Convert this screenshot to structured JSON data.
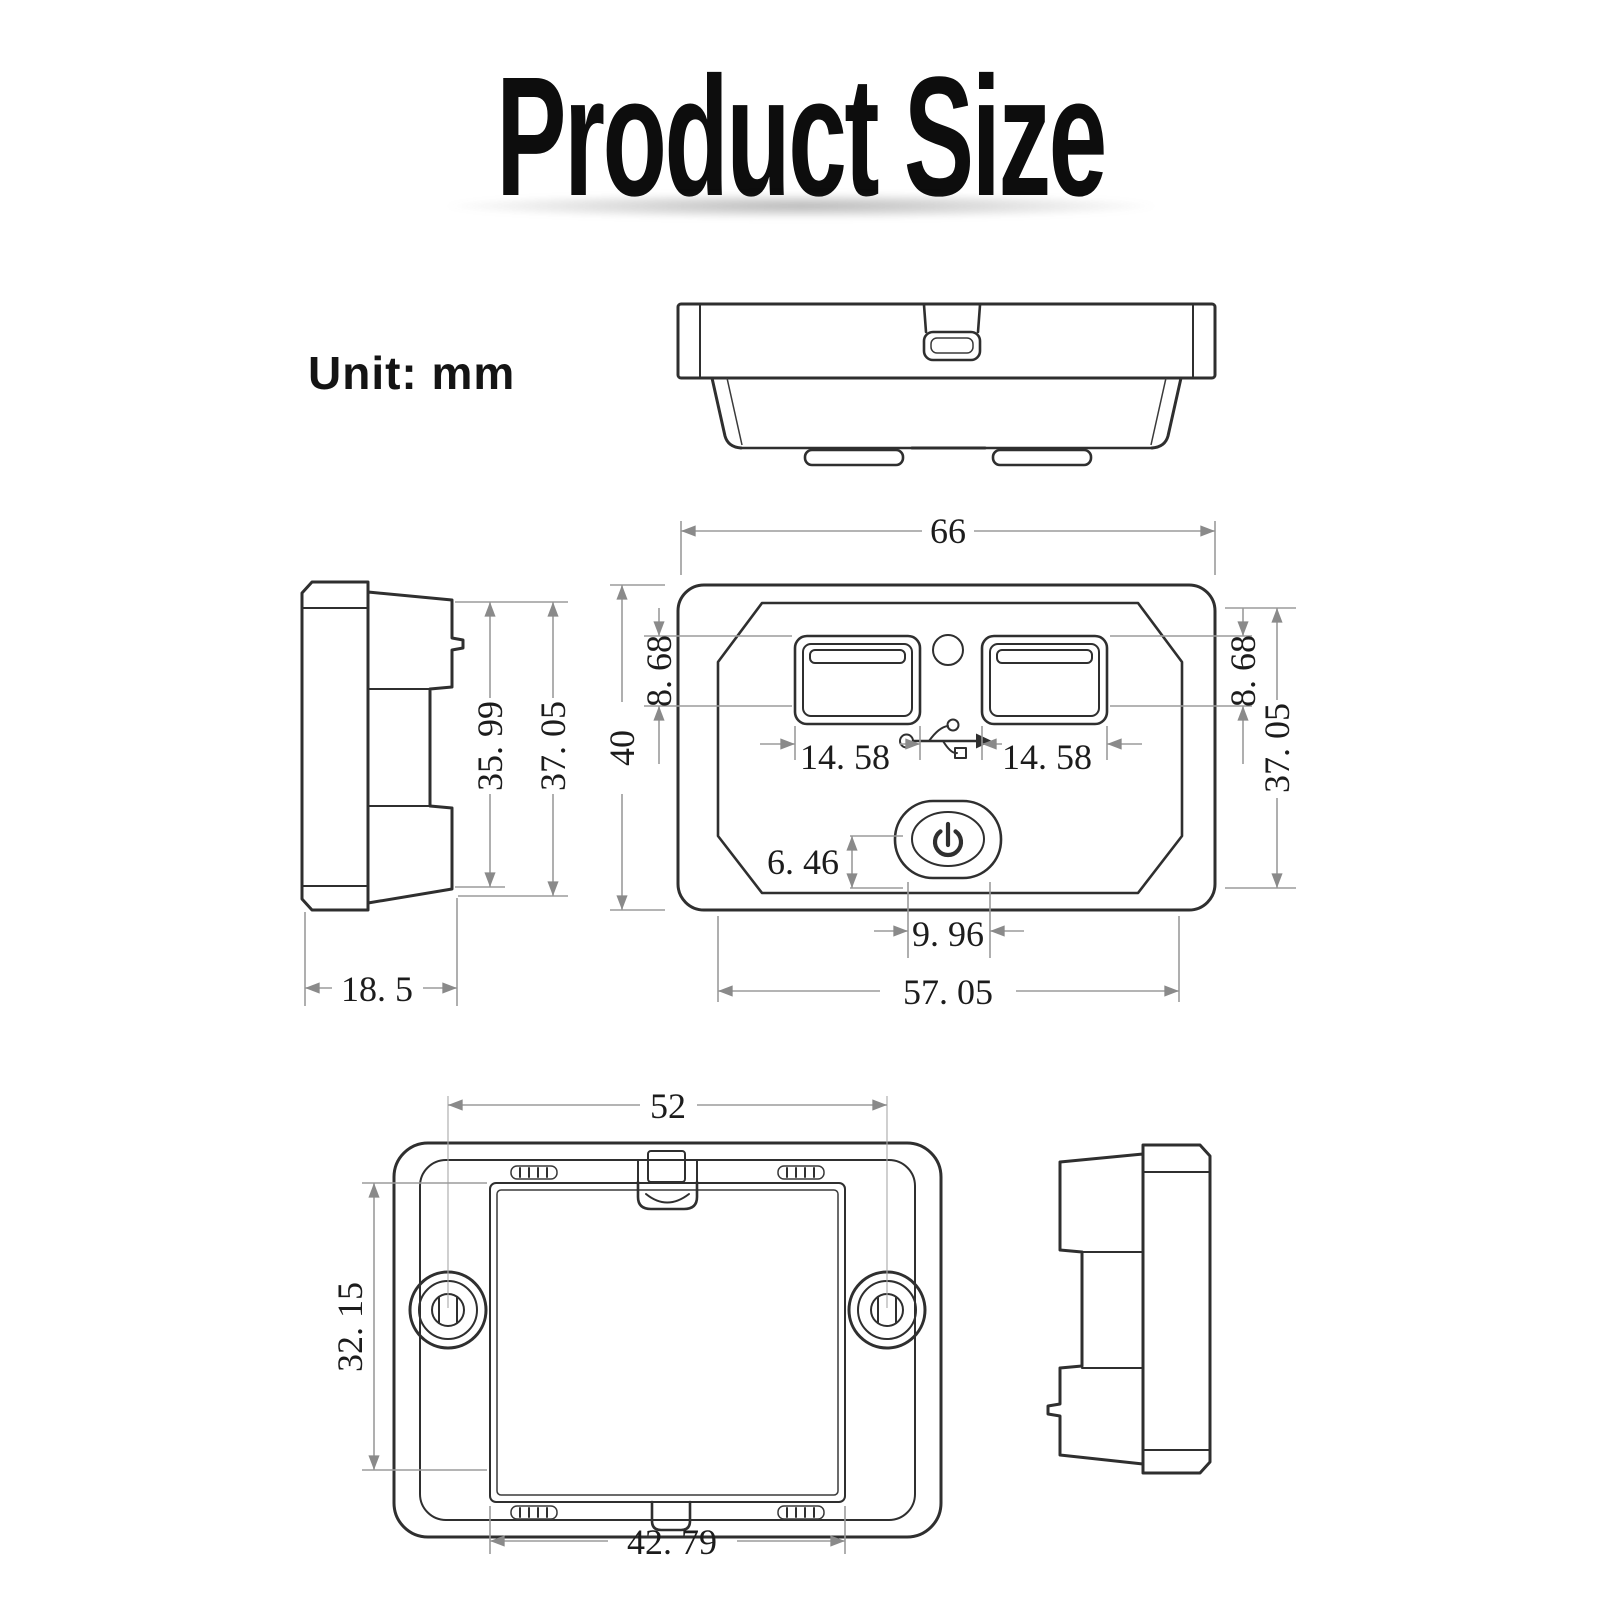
{
  "page": {
    "title": "Product Size",
    "unit_label": "Unit: mm"
  },
  "colors": {
    "background": "#ffffff",
    "part_outline": "#2f2f2f",
    "dimension_lines": "#9b9b9b",
    "dimension_text": "#1c1c1c",
    "title_text": "#0d0d0d"
  },
  "front_view": {
    "overall_width": "66",
    "overall_height": "40",
    "usb_top_offset_left": "8. 68",
    "usb_top_offset_right": "8. 68",
    "panel_height": "37. 05",
    "usb_port_width_left": "14. 58",
    "usb_port_width_right": "14. 58",
    "power_button_height": "6. 46",
    "power_button_width": "9. 96",
    "panel_width": "57. 05",
    "icons": {
      "led": "led-indicator-icon",
      "usb": "usb-trident-icon",
      "power": "power-button-icon"
    }
  },
  "side_view_left": {
    "inner_height": "35. 99",
    "outer_height": "37. 05",
    "depth": "18. 5"
  },
  "back_view": {
    "mount_hole_spacing": "52",
    "cutout_height": "32. 15",
    "cutout_width": "42. 79"
  }
}
